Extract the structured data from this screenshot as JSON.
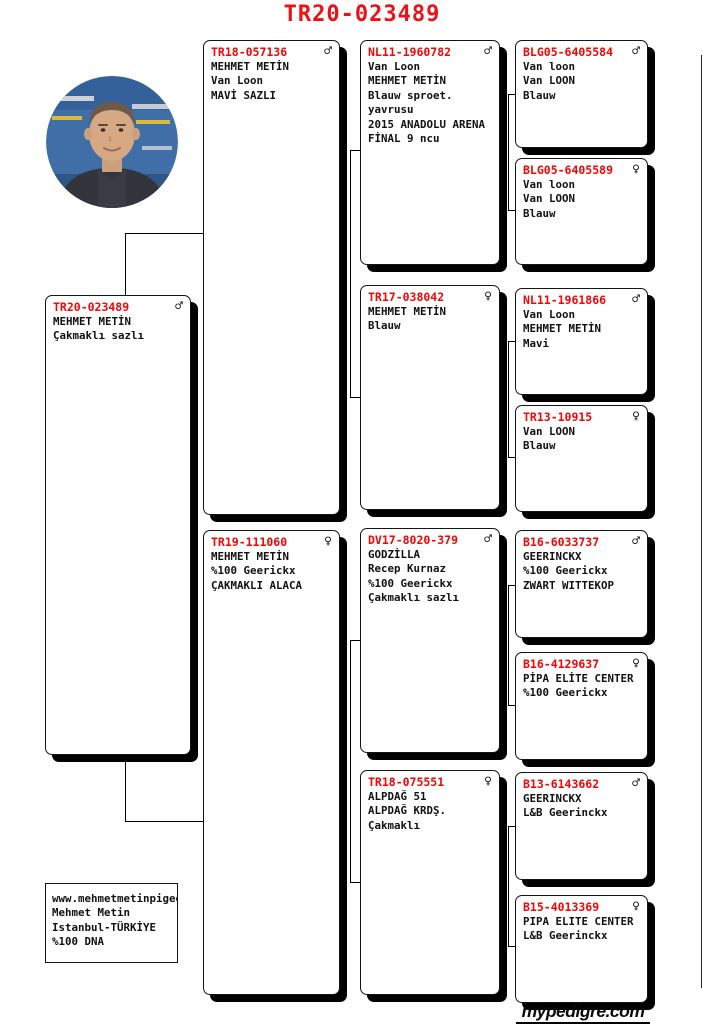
{
  "page": {
    "title": "TR20-023489",
    "footer_logo": "mypedigre.com"
  },
  "colors": {
    "ring_red": "#f20505",
    "title_red": "#ee1016",
    "line_black": "#000000"
  },
  "owner_box": {
    "lines": [
      "www.mehmetmetinpigeons.co",
      "Mehmet Metin",
      "Istanbul-TÜRKİYE",
      "%100 DNA"
    ]
  },
  "pedigree": {
    "subject": {
      "ring": "TR20-023489",
      "sex": "♂",
      "lines": [
        "MEHMET METİN",
        "Çakmaklı sazlı"
      ]
    },
    "gen2": [
      {
        "ring": "TR18-057136",
        "sex": "♂",
        "lines": [
          "MEHMET METİN",
          "Van Loon",
          "MAVİ SAZLI"
        ]
      },
      {
        "ring": "TR19-111060",
        "sex": "♀",
        "lines": [
          "MEHMET METİN",
          "%100 Geerickx",
          "ÇAKMAKLI ALACA"
        ]
      }
    ],
    "gen3": [
      {
        "ring": "NL11-1960782",
        "sex": "♂",
        "lines": [
          "Van Loon",
          "MEHMET METİN",
          "Blauw sproet.",
          "yavrusu",
          "2015 ANADOLU ARENA",
          "FİNAL 9 ncu"
        ]
      },
      {
        "ring": "TR17-038042",
        "sex": "♀",
        "lines": [
          "MEHMET METİN",
          "Blauw"
        ]
      },
      {
        "ring": "DV17-8020-379",
        "sex": "♂",
        "lines": [
          "GODZİLLA",
          "Recep Kurnaz",
          "%100 Geerickx",
          "Çakmaklı sazlı"
        ]
      },
      {
        "ring": "TR18-075551",
        "sex": "♀",
        "lines": [
          "ALPDAĞ 51",
          "ALPDAĞ KRDŞ.",
          "Çakmaklı"
        ]
      }
    ],
    "gen4": [
      {
        "ring": "BLG05-6405584",
        "sex": "♂",
        "lines": [
          "Van loon",
          "Van LOON",
          "Blauw"
        ]
      },
      {
        "ring": "BLG05-6405589",
        "sex": "♀",
        "lines": [
          "Van loon",
          "Van LOON",
          "Blauw"
        ]
      },
      {
        "ring": "NL11-1961866",
        "sex": "♂",
        "lines": [
          "Van Loon",
          "MEHMET METİN",
          "Mavi"
        ]
      },
      {
        "ring": "TR13-10915",
        "sex": "♀",
        "lines": [
          "Van LOON",
          "Blauw"
        ]
      },
      {
        "ring": "B16-6033737",
        "sex": "♂",
        "lines": [
          "GEERINCKX",
          "%100 Geerickx",
          "ZWART WITTEKOP"
        ]
      },
      {
        "ring": "B16-4129637",
        "sex": "♀",
        "lines": [
          "PİPA ELİTE CENTER",
          "%100 Geerickx"
        ]
      },
      {
        "ring": "B13-6143662",
        "sex": "♂",
        "lines": [
          "GEERINCKX",
          "L&B Geerinckx"
        ]
      },
      {
        "ring": "B15-4013369",
        "sex": "♀",
        "lines": [
          "PIPA ELITE CENTER",
          "L&B Geerinckx"
        ]
      }
    ]
  }
}
